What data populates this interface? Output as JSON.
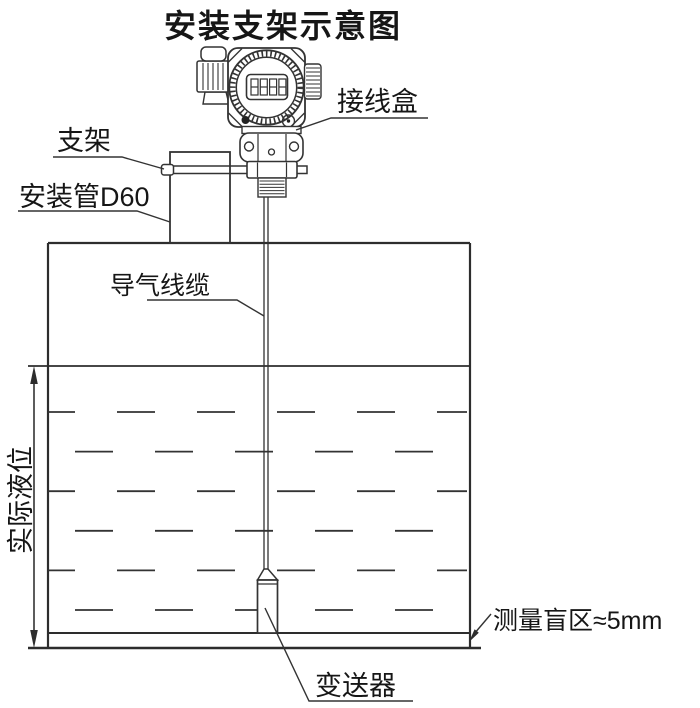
{
  "title": "安装支架示意图",
  "labels": {
    "junction_box": "接线盒",
    "bracket": "支架",
    "mounting_pipe": "安装管D60",
    "air_cable": "导气线缆",
    "actual_level": "实际液位",
    "blind_zone": "测量盲区≈5mm",
    "transmitter": "变送器"
  },
  "display_value": "8888",
  "colors": {
    "line": "#333333",
    "text": "#161616",
    "background": "#ffffff"
  }
}
